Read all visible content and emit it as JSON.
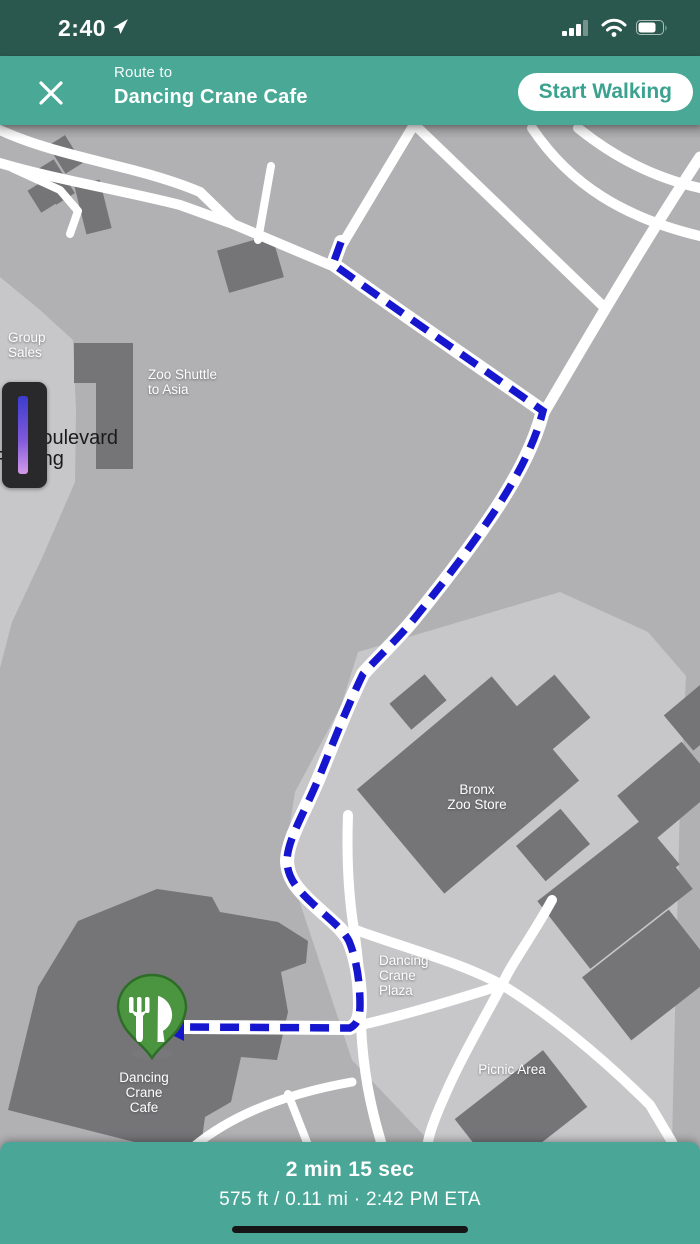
{
  "status_bar": {
    "time": "2:40",
    "location_services_on": true,
    "signal_bars": 3,
    "signal_bars_total": 4,
    "wifi_on": true,
    "battery_percent": 70
  },
  "header": {
    "subtitle": "Route to",
    "title": "Dancing Crane Cafe",
    "start_button_label": "Start Walking"
  },
  "map": {
    "labels": {
      "group_sales": {
        "line1": "Group",
        "line2": "Sales"
      },
      "zoo_shuttle_to_asia": {
        "line1": "Zoo Shuttle",
        "line2": "to Asia"
      },
      "boulevard": {
        "line1": "Boulevard"
      },
      "parking": {
        "line1": "Parking"
      },
      "bronx_zoo_store": {
        "line1": "Bronx",
        "line2": "Zoo Store"
      },
      "dancing_crane_plaza": {
        "line1": "Dancing",
        "line2": "Crane",
        "line3": "Plaza"
      },
      "picnic_area": {
        "line1": "Picnic Area"
      },
      "dancing_crane_cafe": {
        "line1": "Dancing",
        "line2": "Crane",
        "line3": "Cafe"
      }
    },
    "pin": {
      "type": "restaurant",
      "icon": "fork-and-knife",
      "color": "#4b9540"
    },
    "route": {
      "style": "dashed",
      "color": "#1616cf"
    },
    "colors": {
      "base": "#b1b1b3",
      "plaza": "#c7c7c9",
      "building": "#757578",
      "road": "#ffffff"
    }
  },
  "footer": {
    "duration": "2 min 15 sec",
    "details": "575 ft / 0.11 mi · 2:42 PM ETA"
  },
  "colors": {
    "status_bar_bg": "#2b584e",
    "header_bg": "#4aa897",
    "accent_teal": "#3ba28f",
    "route_blue": "#1616cf",
    "pin_green": "#4b9540"
  }
}
